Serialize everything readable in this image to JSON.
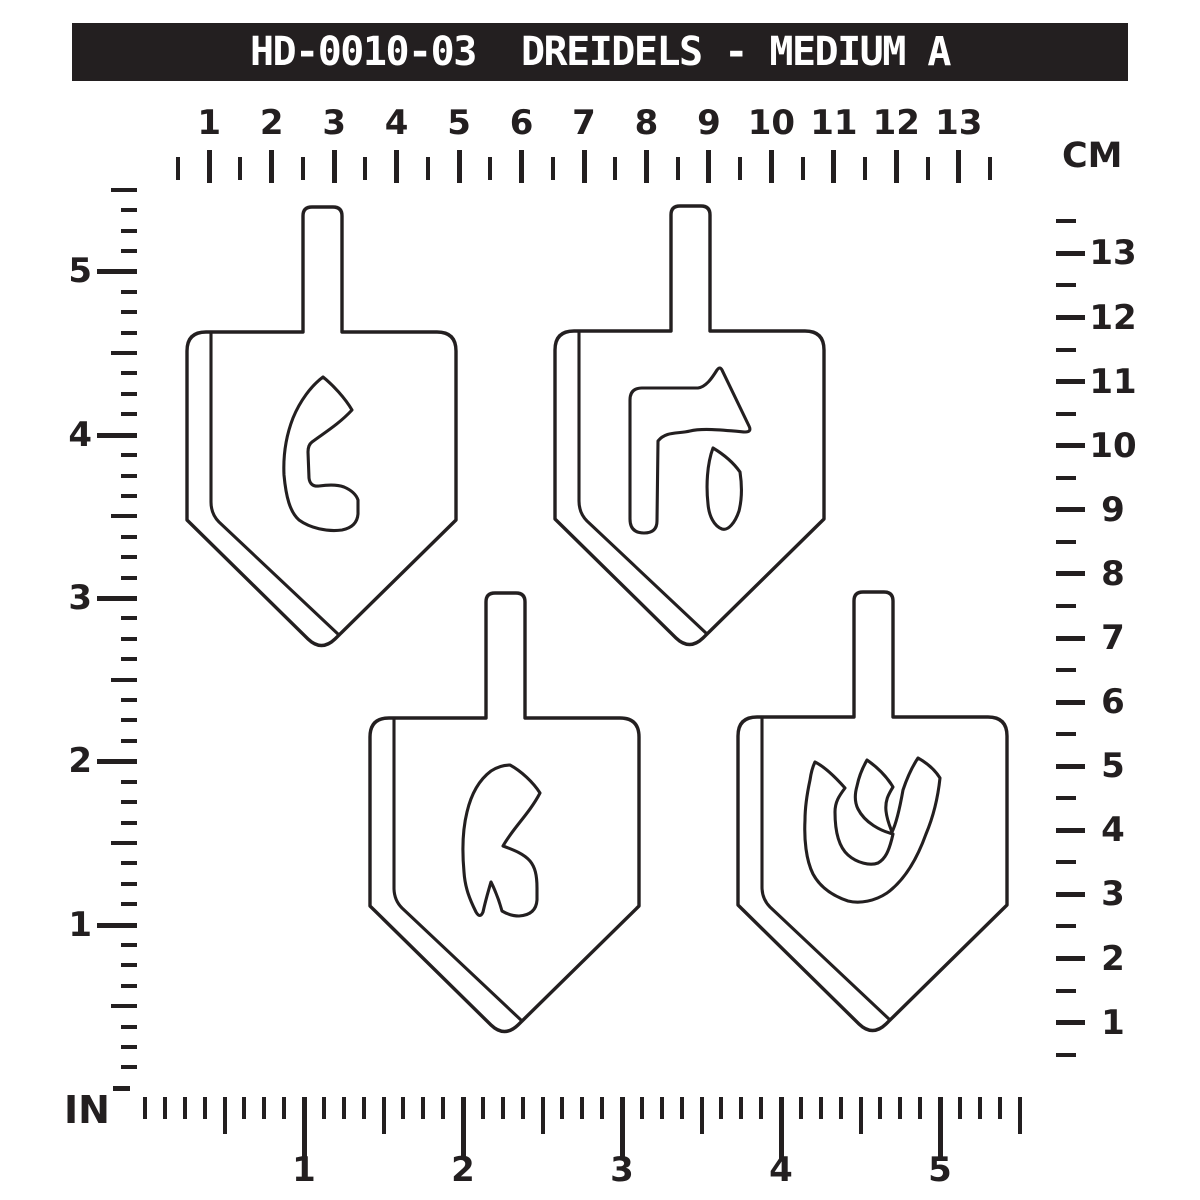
{
  "title_bar": {
    "text": "HD-0010-03  DREIDELS - MEDIUM A"
  },
  "rulers": {
    "top": {
      "unit_label": "CM",
      "numbers": [
        1,
        2,
        3,
        4,
        5,
        6,
        7,
        8,
        9,
        10,
        11,
        12,
        13
      ]
    },
    "right": {
      "numbers": [
        13,
        12,
        11,
        10,
        9,
        8,
        7,
        6,
        5,
        4,
        3,
        2,
        1
      ]
    },
    "left": {
      "unit_label": "IN",
      "numbers": [
        5,
        4,
        3,
        2,
        1
      ]
    },
    "bottom": {
      "numbers": [
        1,
        2,
        3,
        4,
        5
      ]
    }
  },
  "dreidels": [
    {
      "position": "top-left",
      "letter_name": "nun",
      "letter_glyph": "נ"
    },
    {
      "position": "top-right",
      "letter_name": "hey",
      "letter_glyph": "ה"
    },
    {
      "position": "bottom-left",
      "letter_name": "gimel",
      "letter_glyph": "ג"
    },
    {
      "position": "bottom-right",
      "letter_name": "shin",
      "letter_glyph": "ש"
    }
  ],
  "colors": {
    "ink": "#231f20",
    "background": "#ffffff"
  }
}
